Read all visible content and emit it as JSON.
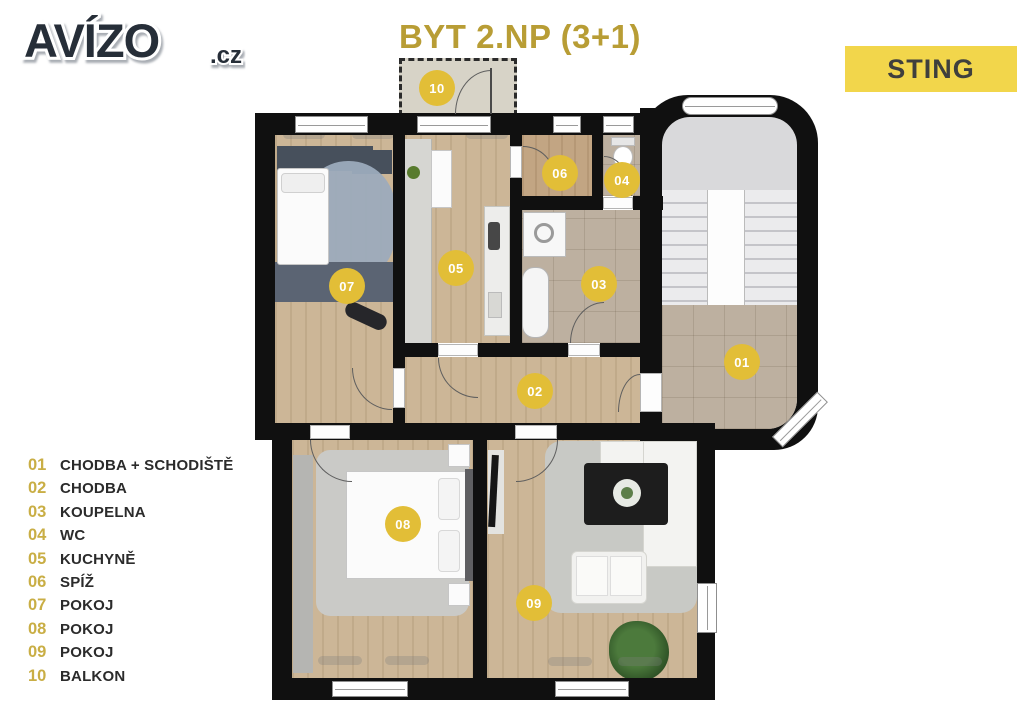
{
  "header": {
    "logo": "AVÍZO",
    "logo_suffix": ".cz",
    "title": "BYT 2.NP (3+1)",
    "badge": "STING"
  },
  "legend": {
    "items": [
      {
        "num": "01",
        "label": "CHODBA + SCHODIŠTĚ"
      },
      {
        "num": "02",
        "label": "CHODBA"
      },
      {
        "num": "03",
        "label": "KOUPELNA"
      },
      {
        "num": "04",
        "label": "WC"
      },
      {
        "num": "05",
        "label": "KUCHYNĚ"
      },
      {
        "num": "06",
        "label": "SPÍŽ"
      },
      {
        "num": "07",
        "label": "POKOJ"
      },
      {
        "num": "08",
        "label": "POKOJ"
      },
      {
        "num": "09",
        "label": "POKOJ"
      },
      {
        "num": "10",
        "label": "BALKON"
      }
    ]
  },
  "plan": {
    "markers": [
      {
        "num": "01",
        "room": "chodba-schodiste"
      },
      {
        "num": "02",
        "room": "chodba"
      },
      {
        "num": "03",
        "room": "koupelna"
      },
      {
        "num": "04",
        "room": "wc"
      },
      {
        "num": "05",
        "room": "kuchyne"
      },
      {
        "num": "06",
        "room": "spiz"
      },
      {
        "num": "07",
        "room": "pokoj"
      },
      {
        "num": "08",
        "room": "pokoj"
      },
      {
        "num": "09",
        "room": "pokoj"
      },
      {
        "num": "10",
        "room": "balkon"
      }
    ]
  },
  "colors": {
    "accent_marker": "#e2be37",
    "badge_bg": "#f2d64b",
    "title_gold": "#b89d35",
    "legend_num_gold": "#c9ae45",
    "wall_black": "#101010",
    "wood_floor": "#ccb697",
    "tile_floor": "#bdb0a0",
    "rug_blue": "#9cabbc",
    "rug_gray": "#cacac7",
    "stair_gray": "#d9d9db"
  }
}
